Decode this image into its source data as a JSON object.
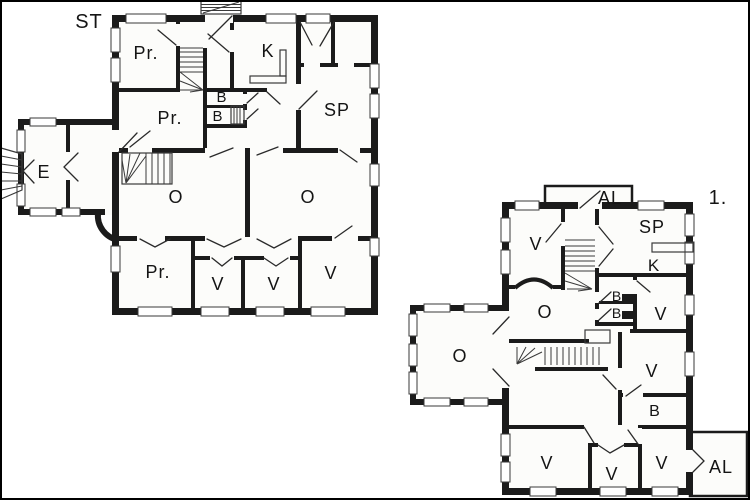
{
  "diagram": {
    "type": "architectural-floor-plan",
    "colors": {
      "wall": "#1b1b1b",
      "floor": "#fcfcfa",
      "background": "#ffffff",
      "line": "#3a3a3a"
    }
  },
  "plans": [
    {
      "name": "ground-floor",
      "floor_label": "ST",
      "rooms": {
        "pr_top": "Pr.",
        "kitchen": "K",
        "sp": "SP",
        "bath_upper": "B",
        "bath_lower": "B",
        "pr_mid": "Pr.",
        "entry": "E",
        "o_left": "O",
        "o_right": "O",
        "pr_bottom": "Pr.",
        "v1": "V",
        "v2": "V",
        "v3": "V"
      }
    },
    {
      "name": "first-floor",
      "floor_label": "1.",
      "rooms": {
        "al_top": "AL",
        "v_nw": "V",
        "sp": "SP",
        "kitchen": "K",
        "bath_upper": "B",
        "bath_lower": "B",
        "v_ne": "V",
        "o_center": "O",
        "o_west": "O",
        "v_mid": "V",
        "bath_south": "B",
        "v_sw": "V",
        "v_s": "V",
        "v_se": "V",
        "al_bottom": "AL"
      }
    }
  ]
}
